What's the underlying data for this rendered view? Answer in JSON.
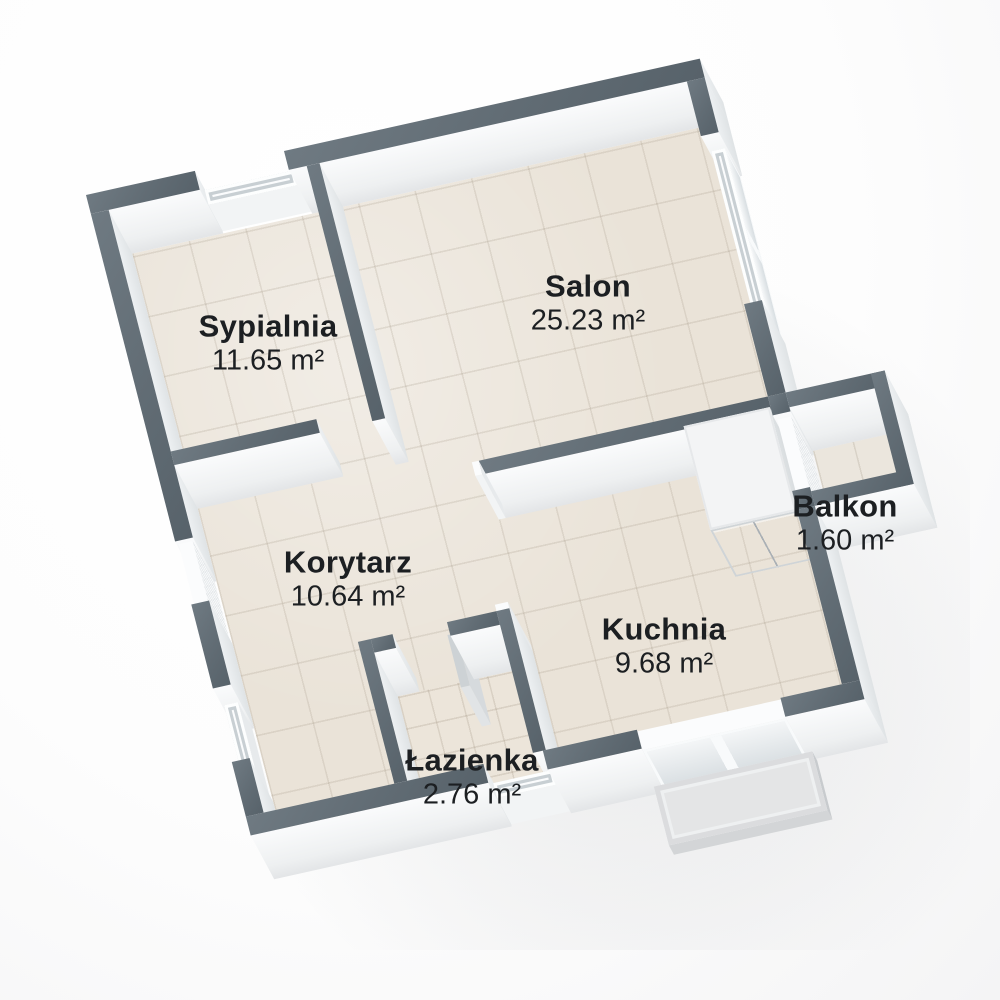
{
  "plan": {
    "rooms": [
      {
        "id": "sypialnia",
        "name": "Sypialnia",
        "area": "11.65 m²"
      },
      {
        "id": "salon",
        "name": "Salon",
        "area": "25.23 m²"
      },
      {
        "id": "korytarz",
        "name": "Korytarz",
        "area": "10.64 m²"
      },
      {
        "id": "balkon",
        "name": "Balkon",
        "area": "1.60 m²"
      },
      {
        "id": "kuchnia",
        "name": "Kuchnia",
        "area": "9.68 m²"
      },
      {
        "id": "lazienka",
        "name": "Łazienka",
        "area": "2.76 m²"
      }
    ],
    "features": [
      "bedroom-window",
      "entrance-door",
      "hallway-window",
      "livingroom-window",
      "balcony-door",
      "terrace-door",
      "bathroom-window",
      "bathroom-door-leaf",
      "kitchen-cabinet",
      "terrace-step"
    ],
    "colors": {
      "wall_top": "#616c74",
      "wall_face": "#f5f6f7",
      "floor": "#eae3d8",
      "label_text": "#1c1f22",
      "background": "#fdfdfd"
    }
  }
}
